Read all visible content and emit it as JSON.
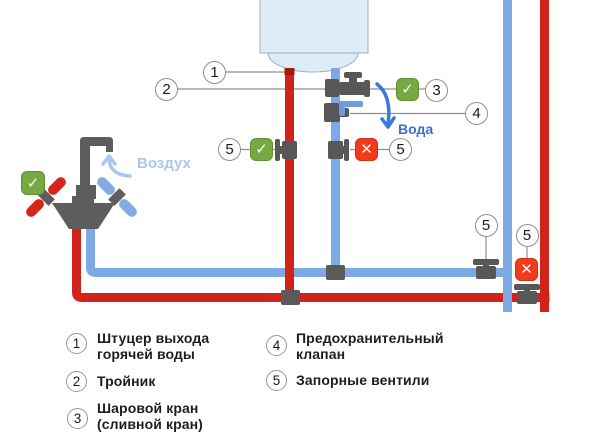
{
  "diagram": {
    "air_flow_label": "Воздух",
    "water_flow_label": "Вода",
    "callouts": {
      "n1": "1",
      "n2": "2",
      "n3": "3",
      "n4": "4",
      "n5": "5"
    },
    "status": {
      "open_ok": "✓",
      "closed": "✕"
    }
  },
  "legend": {
    "items": [
      {
        "num": "1",
        "line1": "Штуцер выхода",
        "line2": "горячей воды"
      },
      {
        "num": "2",
        "line1": "Тройник",
        "line2": ""
      },
      {
        "num": "3",
        "line1": "Шаровой кран",
        "line2": "(сливной кран)"
      },
      {
        "num": "4",
        "line1": "Предохранительный",
        "line2": "клапан"
      },
      {
        "num": "5",
        "line1": "Запорные вентили",
        "line2": ""
      }
    ]
  },
  "colors": {
    "hot_pipe": "#d2231a",
    "cold_pipe": "#7da9e4",
    "ok_green": "#76a843",
    "closed_red": "#f23a1d",
    "metal_gray": "#5d5d5d",
    "boiler_fill": "#ddedf8",
    "boiler_stroke": "#a5adb5",
    "air_label": "#a9c7ee",
    "water_label": "#3b6fc9",
    "callout_border": "#8f8f8f"
  }
}
